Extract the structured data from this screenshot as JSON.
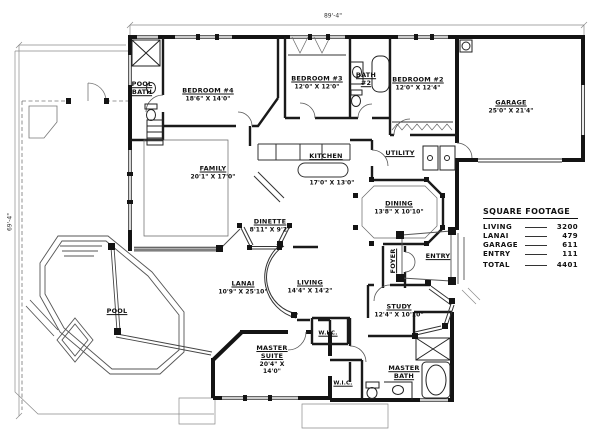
{
  "drawing": {
    "dimensions": {
      "width_label": "89'-4\"",
      "height_label": "69'-4\""
    },
    "rooms": {
      "pool_bath": {
        "name": "POOL BATH"
      },
      "bedroom4": {
        "name": "BEDROOM #4",
        "dims": "18'6\" X 14'0\""
      },
      "bedroom3": {
        "name": "BEDROOM #3",
        "dims": "12'0\" X 12'0\""
      },
      "bath2": {
        "name": "BATH #2"
      },
      "bedroom2": {
        "name": "BEDROOM #2",
        "dims": "12'0\" X 12'4\""
      },
      "garage": {
        "name": "GARAGE",
        "dims": "25'0\" X 21'4\""
      },
      "family": {
        "name": "FAMILY",
        "dims": "20'1\" X 17'0\""
      },
      "kitchen": {
        "name": "KITCHEN",
        "dims": "17'0\" X 13'0\""
      },
      "utility": {
        "name": "UTILITY"
      },
      "dinette": {
        "name": "DINETTE",
        "dims": "8'11\" X 9'2\""
      },
      "dining": {
        "name": "DINING",
        "dims": "13'8\" X 10'10\""
      },
      "foyer": {
        "name": "FOYER"
      },
      "entry": {
        "name": "ENTRY"
      },
      "lanai": {
        "name": "LANAI",
        "dims": "10'9\" X 25'10\""
      },
      "living": {
        "name": "LIVING",
        "dims": "14'4\" X 14'2\""
      },
      "study": {
        "name": "STUDY",
        "dims": "12'4\" X 10'10\""
      },
      "pool": {
        "name": "POOL"
      },
      "master_suite": {
        "name": "MASTER SUITE",
        "dims": "20'4\" X 14'0\""
      },
      "wic_1": {
        "name": "W.I.C."
      },
      "wic_2": {
        "name": "W.I.C."
      },
      "master_bath": {
        "name": "MASTER BATH"
      }
    },
    "square_footage": {
      "title": "SQUARE FOOTAGE",
      "rows": [
        {
          "label": "LIVING",
          "value": "3200"
        },
        {
          "label": "LANAI",
          "value": "479"
        },
        {
          "label": "GARAGE",
          "value": "611"
        },
        {
          "label": "ENTRY",
          "value": "111"
        },
        {
          "label": "TOTAL",
          "value": "4401"
        }
      ]
    }
  }
}
